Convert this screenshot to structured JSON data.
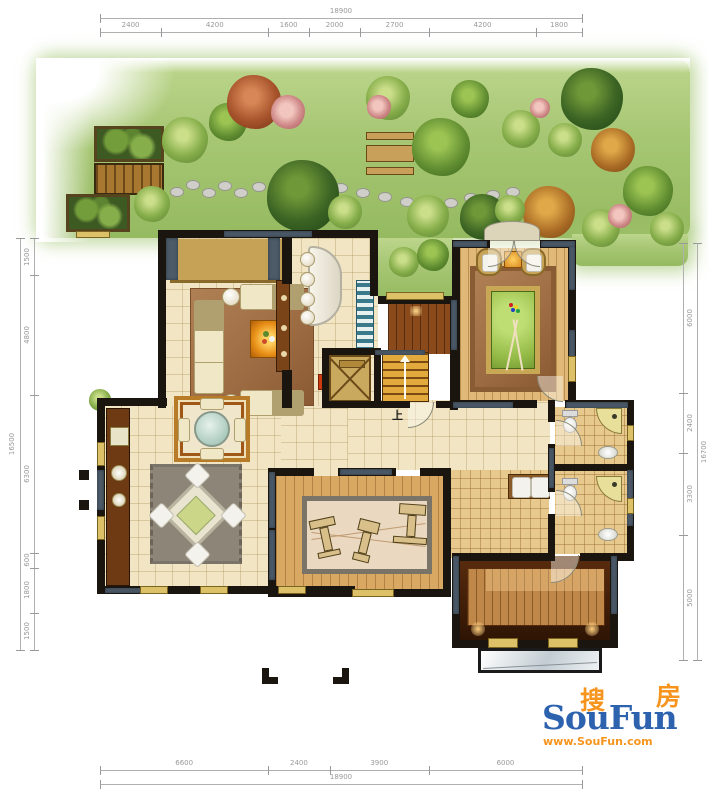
{
  "dimensions": {
    "top": {
      "total": "18900",
      "segments": [
        "2400",
        "4200",
        "1600",
        "2000",
        "2700",
        "4200",
        "1800"
      ]
    },
    "bottom": {
      "total": "18900",
      "segments": [
        "6600",
        "2400",
        "3900",
        "6000"
      ]
    },
    "left": {
      "total": "16500",
      "segments": [
        "1500",
        "4800",
        "6300",
        "600",
        "1800",
        "1500"
      ]
    },
    "right": {
      "total": "16700",
      "segments": [
        "6000",
        "2400",
        "3300",
        "5000"
      ]
    }
  },
  "plan": {
    "stair_direction_label": "上"
  },
  "logo": {
    "cn_first": "搜",
    "cn_second": "房",
    "brand": "SouFun",
    "url": "www.SouFun.com",
    "brand_color": "#2d62ae",
    "accent_color": "#f7941d"
  },
  "colors": {
    "garden_green": "#a6c873",
    "wall_black": "#1a150f",
    "wall_accent": "#4d5a68",
    "floor_marble": "#f1e5c4",
    "floor_wood_billiard": "#e0b877",
    "floor_wood_gym": "#d9a963",
    "floor_tile_tan": "#e7c98e",
    "billiard_felt": "#a9c95b",
    "window_frame": "#dcc169"
  }
}
